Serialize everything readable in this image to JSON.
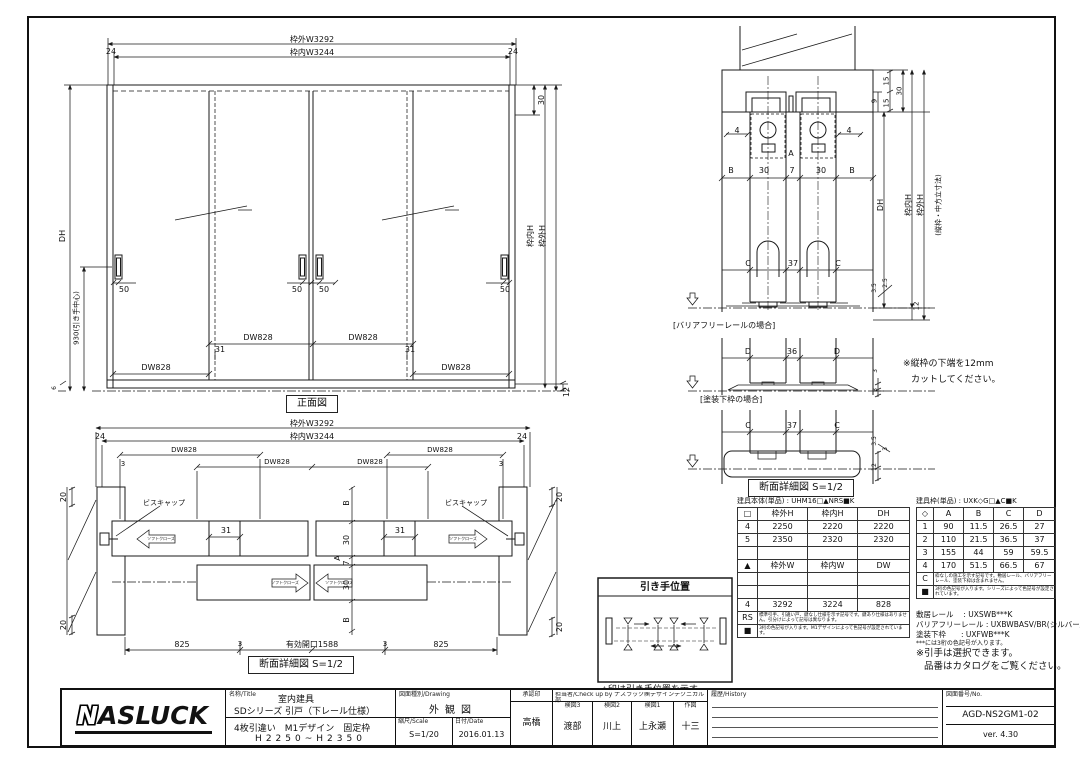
{
  "front_view": {
    "title": "正面図",
    "outer_w": "枠外W3292",
    "inner_w": "枠内W3244",
    "d24": "24",
    "d30": "30",
    "d12": "12",
    "d6": "6",
    "dh": "DH",
    "handle_center": "930(引き手中心)",
    "inner_h": "枠内H",
    "outer_h": "枠外H",
    "d50": "50",
    "d31": "31",
    "dw": "DW828"
  },
  "plan_section": {
    "title": "断面詳細図 S=1/2",
    "outer_w": "枠外W3292",
    "inner_w": "枠内W3244",
    "d24": "24",
    "d3": "3",
    "d20": "20",
    "d31": "31",
    "dw": "DW828",
    "screw_cap": "ビスキャップ",
    "soft_close": "ソフトクローズ",
    "b": "B",
    "d30": "30",
    "d7": "7",
    "a": "A",
    "d825": "825",
    "opening": "有効開口1588"
  },
  "vert_section": {
    "title": "断面詳細図 S=1/2",
    "case_barrier": "[バリアフリーレールの場合]",
    "case_painted": "[塗装下枠の場合]",
    "note1": "※縦枠の下端を12mm",
    "note2": "カットしてください。",
    "a": "A",
    "b": "B",
    "c": "C",
    "d": "D",
    "d4": "4",
    "d7": "7",
    "d30": "30",
    "d37": "37",
    "d36": "36",
    "d9": "9",
    "d15": "15",
    "d3": "3",
    "d35": "3.5",
    "d25": "2.5",
    "d12": "12",
    "dh": "DH",
    "inner_h": "枠内H",
    "outer_h": "枠外H",
    "frame_dim_note": "(縦枠・中方立寸法)"
  },
  "handle_box": {
    "title": "引き手位置",
    "caption": "△印は引き手位置を示す。"
  },
  "body_table": {
    "title": "建具本体(単品) : UHM16□▲NRS■K",
    "rows": [
      [
        "□",
        "枠外H",
        "枠内H",
        "DH"
      ],
      [
        "4",
        "2250",
        "2220",
        "2220"
      ],
      [
        "5",
        "2350",
        "2320",
        "2320"
      ],
      [
        "",
        "",
        "",
        ""
      ],
      [
        "▲",
        "枠外W",
        "枠内W",
        "DW"
      ],
      [
        "",
        "",
        "",
        ""
      ],
      [
        "",
        "",
        "",
        ""
      ],
      [
        "4",
        "3292",
        "3224",
        "828"
      ],
      [
        "RS",
        "標準引手、引違い戸、鍵なし仕様を示す記号です。鍵あり仕様はありません。引分けによって記号は異なります。"
      ],
      [
        "■",
        "3桁の色記号が入ります。M1デザインによって色記号が設定されています。"
      ]
    ]
  },
  "frame_table": {
    "title": "建具枠(単品) : UXK◇G□▲C■K",
    "rows": [
      [
        "◇",
        "A",
        "B",
        "C",
        "D"
      ],
      [
        "1",
        "90",
        "11.5",
        "26.5",
        "27"
      ],
      [
        "2",
        "110",
        "21.5",
        "36.5",
        "37"
      ],
      [
        "3",
        "155",
        "44",
        "59",
        "59.5"
      ],
      [
        "4",
        "170",
        "51.5",
        "66.5",
        "67"
      ],
      [
        "C",
        "枠なしの施工を示す記号です。敷居レール、バリアフリーレール、塗装下枠は含まれません。"
      ],
      [
        "■",
        "3桁の色記号が入ります。シリーズによって色記号が設定されています。"
      ]
    ]
  },
  "rail_notes": {
    "line1": "敷居レール　 : UXSWB***K",
    "line2": "バリアフリーレール : UXBWBASV/BR(シルバー/ブロンズ)",
    "line3": "塗装下枠　　: UXFWB***K",
    "line4": "***には3桁の色記号が入ります。",
    "line5": "※引手は選択できます。",
    "line6": "品番はカタログをご覧ください。"
  },
  "title_block": {
    "logo": "ASLUCK",
    "logo_n": "N",
    "name_label": "名称/Title",
    "name1": "室内建具",
    "name2": "SDシリーズ 引戸（下レール仕様）",
    "name3": "4枚引違い　M1デザイン　固定枠",
    "name4": "H2250~H2350",
    "drawing_label": "図面種別/Drawing",
    "drawing": "外観図",
    "scale_label": "縮尺/Scale",
    "scale": "S=1/20",
    "date_label": "日付/Date",
    "date": "2016.01.13",
    "approve_label": "承認印",
    "approver": "高橋",
    "check_header": "担当者/Check up by ナスラック㈱デザインテクニカル部",
    "check3_label": "検図3",
    "check3": "渡部",
    "check2_label": "検図2",
    "check2": "川上",
    "check1_label": "検図1",
    "check1": "上永瀬",
    "draw_label": "作図",
    "drawn": "十三",
    "history_label": "履歴/History",
    "no_label": "図面番号/No.",
    "number": "AGD-NS2GM1-02",
    "version": "ver. 4.30"
  }
}
